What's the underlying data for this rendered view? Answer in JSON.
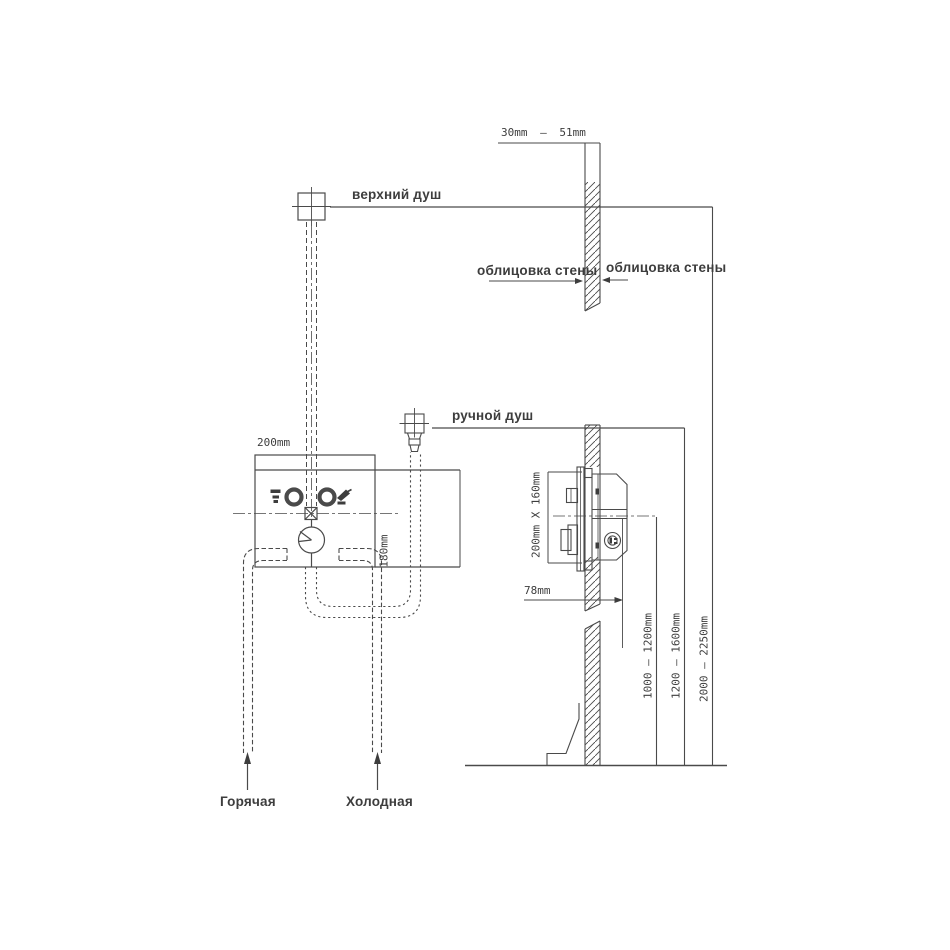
{
  "labels": {
    "top_shower": "верхний душ",
    "hand_shower": "ручной душ",
    "wall_cladding_left": "облицовка стены",
    "wall_cladding_right": "облицовка стены",
    "hot_water": "Горячая",
    "cold_water": "Холодная"
  },
  "dimensions": {
    "cladding_thickness": "30mm – 51mm",
    "box_width": "200mm",
    "box_height": "180mm",
    "box_face": "200mm X 160mm",
    "box_depth": "78mm",
    "mixer_height": "1000 — 1200mm",
    "hand_shower_height": "1200 — 1600mm",
    "top_shower_height": "2000 — 2250mm"
  },
  "colors": {
    "line": "#4a4a4a",
    "text": "#3d3d3d",
    "background": "#ffffff"
  }
}
